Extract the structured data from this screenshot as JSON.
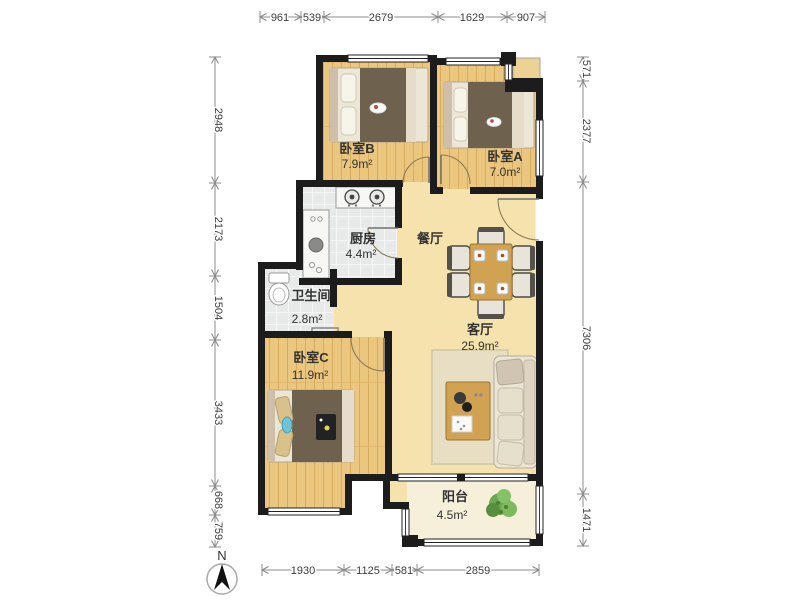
{
  "rooms": {
    "bedroom_b": {
      "name": "卧室B",
      "area": "7.9m²"
    },
    "bedroom_a": {
      "name": "卧室A",
      "area": "7.0m²"
    },
    "kitchen": {
      "name": "厨房",
      "area": "4.4m²"
    },
    "dining": {
      "name": "餐厅"
    },
    "bathroom": {
      "name": "卫生间",
      "area": "2.8m²"
    },
    "living": {
      "name": "客厅",
      "area": "25.9m²"
    },
    "bedroom_c": {
      "name": "卧室C",
      "area": "11.9m²"
    },
    "balcony": {
      "name": "阳台",
      "area": "4.5m²"
    }
  },
  "dimensions": {
    "top": [
      "961",
      "539",
      "2679",
      "1629",
      "907"
    ],
    "left": [
      "2948",
      "2173",
      "1504",
      "3433",
      "668",
      "759"
    ],
    "right": [
      "571",
      "2377",
      "7306",
      "1471"
    ],
    "bottom": [
      "1930",
      "1125",
      "581",
      "2859"
    ]
  },
  "compass": {
    "label": "N"
  },
  "colors": {
    "wall": "#1c1c1c",
    "wood_floor": "#ebc67e",
    "living_floor": "#f6e2ac",
    "tile_floor": "#e8eae9",
    "balcony_floor": "#f6f0da",
    "blanket": "#6e614e",
    "table_wood": "#d2a253",
    "plant": "#6aa84f",
    "dimension_line": "#8c8c8c"
  }
}
